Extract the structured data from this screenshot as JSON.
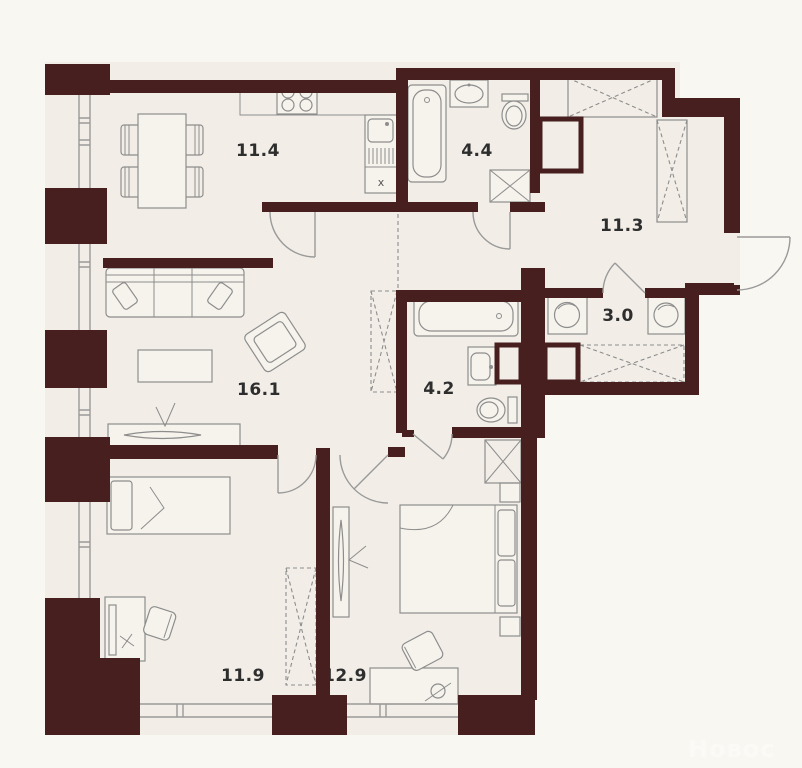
{
  "plan": {
    "watermark": "Новос",
    "marks": {
      "kitchen_cabinet": "x"
    },
    "colors": {
      "wall": "#471f1f",
      "floor": "#f2eee7",
      "outside": "#f9f7f2",
      "line": "#8d8d8d",
      "label": "#2e2e2e"
    },
    "rooms": [
      {
        "name": "kitchen-dining",
        "area": "11.4"
      },
      {
        "name": "bathroom-small",
        "area": "4.4"
      },
      {
        "name": "hallway",
        "area": "11.3"
      },
      {
        "name": "laundry",
        "area": "3.0"
      },
      {
        "name": "living-room",
        "area": "16.1"
      },
      {
        "name": "bathroom-main",
        "area": "4.2"
      },
      {
        "name": "bedroom-one",
        "area": "11.9"
      },
      {
        "name": "bedroom-two",
        "area": "12.9"
      }
    ]
  }
}
